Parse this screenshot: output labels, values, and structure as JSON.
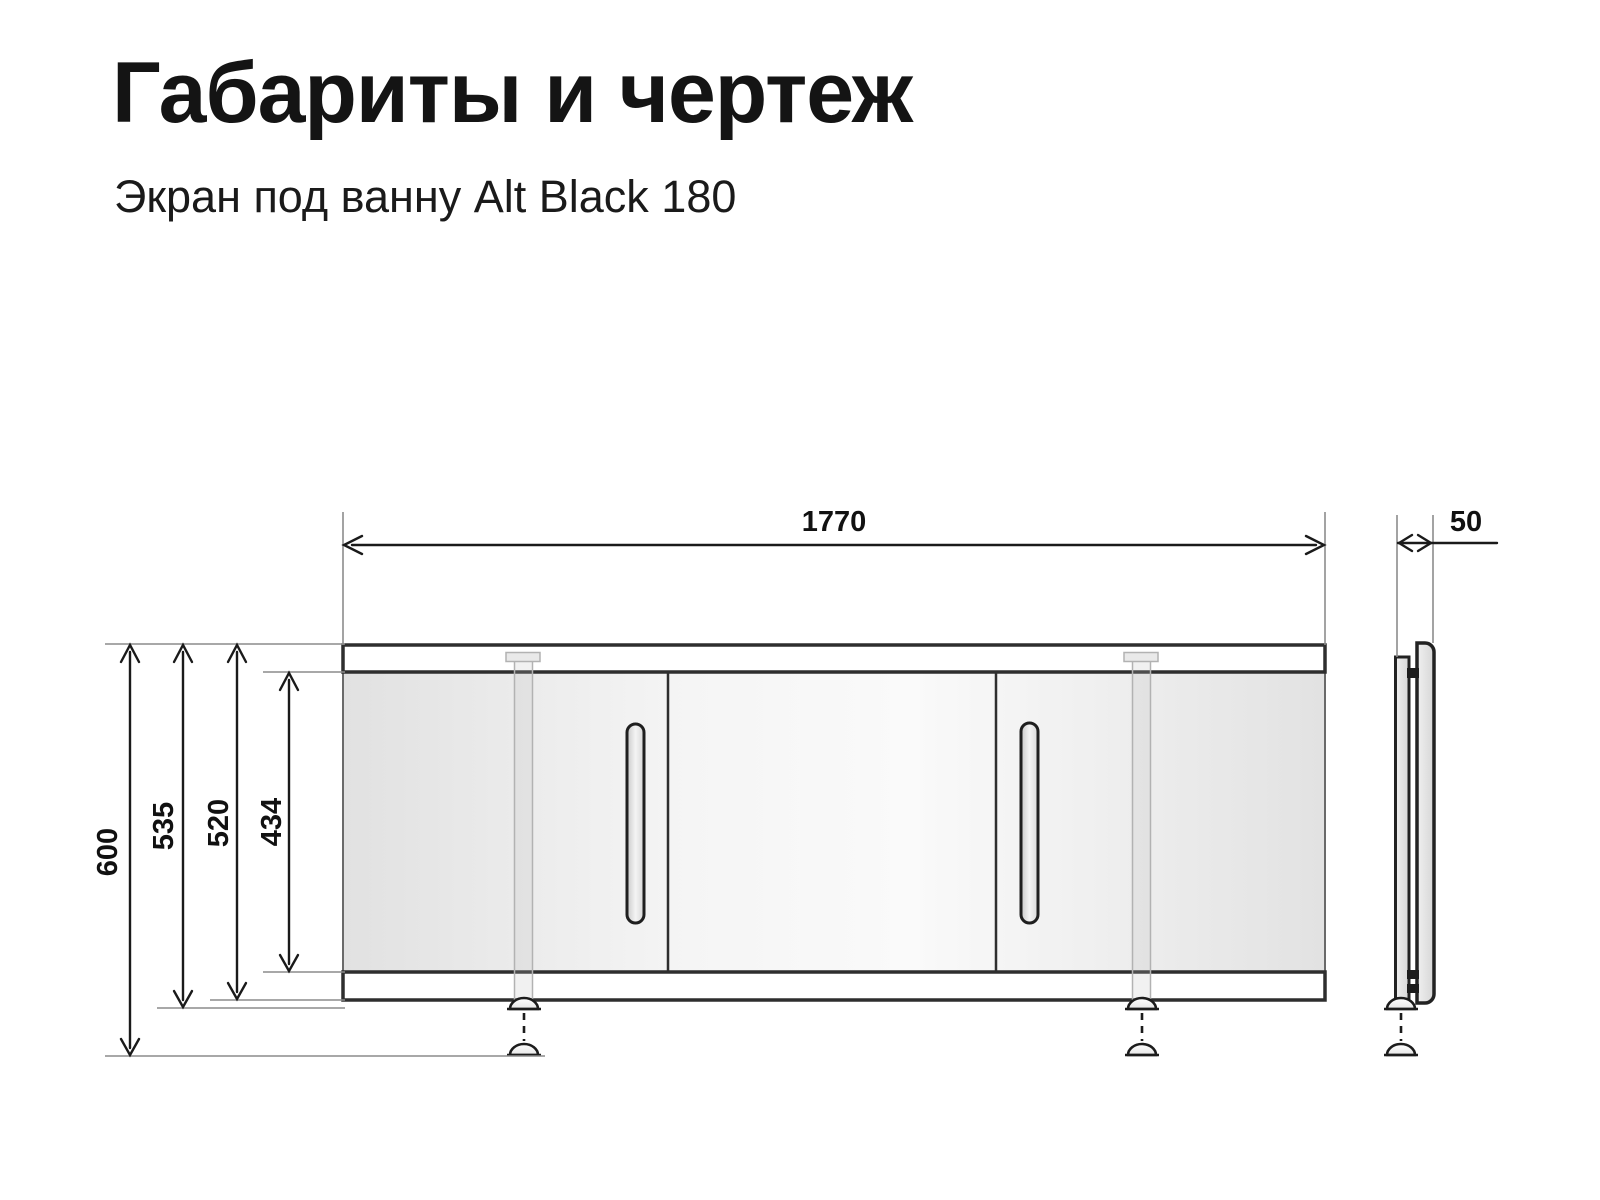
{
  "header": {
    "title": "Габариты и чертеж",
    "subtitle": "Экран под ванну Alt Black 180"
  },
  "dimensions": {
    "width": "1770",
    "depth": "50",
    "height_total": "600",
    "height_with_feet": "535",
    "height_panel": "520",
    "height_door": "434"
  },
  "colors": {
    "background": "#ffffff",
    "text": "#141414",
    "outline": "#2e2e2e",
    "dimension_line": "#1a1a1a",
    "extension_line": "#8c8c8c",
    "panel_fill_light": "#fafafa",
    "panel_fill_shade": "#e1e1e1"
  }
}
